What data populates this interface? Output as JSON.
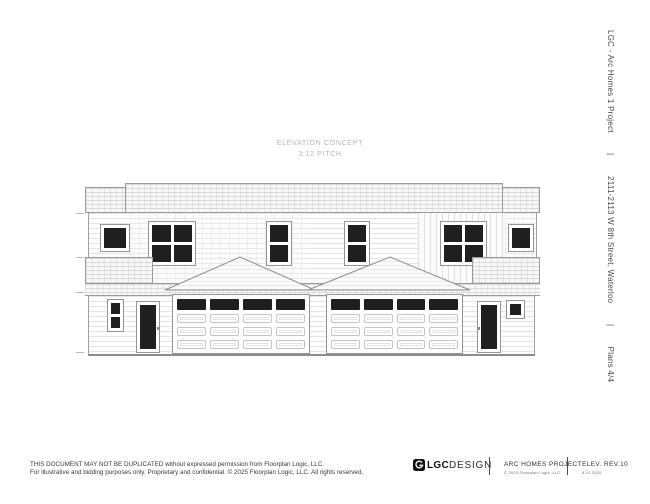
{
  "page": {
    "concept": {
      "line1": "ELEVATION CONCEPT",
      "line2": "3:12 PITCH"
    },
    "sidebar": {
      "project": "LGC - Arc Homes 1 Project",
      "sep1": "|",
      "address": "2111-2113 W 8th Street, Waterloo",
      "sep2": "|",
      "plans": "Plans 4/4"
    },
    "footer": {
      "disclaimer1": "THIS DOCUMENT MAY NOT BE DUPLICATED without expressed permission from Floorplan Logic, LLC.",
      "disclaimer2": "For illustrative and bidding purposes only. Proprietary and confidential.  © 2025 Floorplan Logic, LLC. All rights reserved.",
      "brand_bold": "LGC",
      "brand_light": "DESIGN",
      "project": "ARC HOMES PROJECT",
      "copyright": "© 2025 Floorplan Logic, LLC",
      "revision": "ELEV. REV.10",
      "date": "6.12.2025"
    },
    "colors": {
      "line_gray": "#9a9a9a",
      "window_glass": "#1f1f1f",
      "concept_text": "#b5b5b5",
      "body_text": "#3d3d3d"
    },
    "drawing": {
      "type": "duplex-front-elevation",
      "pitch": "3:12",
      "upper_windows": 6,
      "entry_doors": 2,
      "garage_doors": 2,
      "garage_panel_grid": "4x4",
      "garage_lite_row": "top row dark lites",
      "gables": 2
    }
  }
}
